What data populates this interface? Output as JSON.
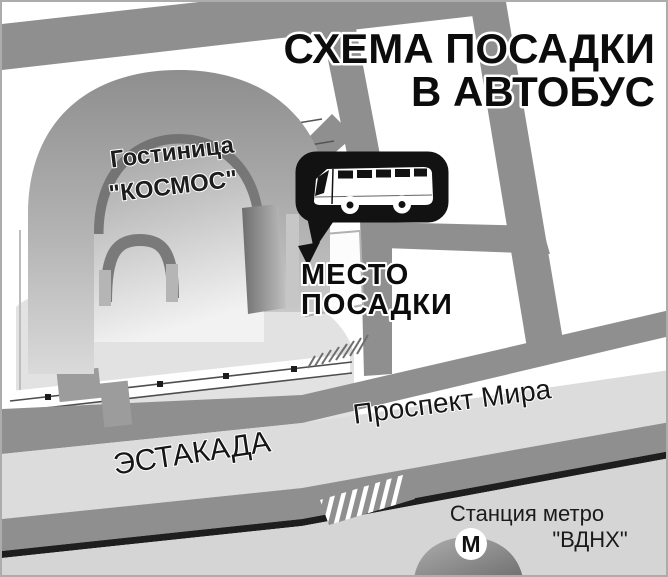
{
  "title": {
    "line1": "СХЕМА ПОСАДКИ",
    "line2": "В АВТОБУС"
  },
  "hotel": {
    "name_line1": "Гостиница",
    "name_line2": "\"КОСМОС\""
  },
  "boarding_point": {
    "label_line1": "МЕСТО",
    "label_line2": "ПОСАДКИ",
    "icon": "bus-icon"
  },
  "streets": {
    "overpass_label": "ЭСТАКАДА",
    "avenue_label": "Проспект Мира"
  },
  "metro": {
    "station_line1": "Станция метро",
    "station_line2": "\"ВДНХ\"",
    "symbol": "М",
    "icon": "metro-m-icon"
  },
  "colors": {
    "road_gray": "#8f8f8f",
    "overpass_light": "#dcdcdc",
    "bottom_area": "#d5d5d5",
    "plaza": "#e2e2e2",
    "callout_black": "#121212",
    "road_edge_black": "#1e1e1e",
    "text_black": "#0c0c0c"
  }
}
